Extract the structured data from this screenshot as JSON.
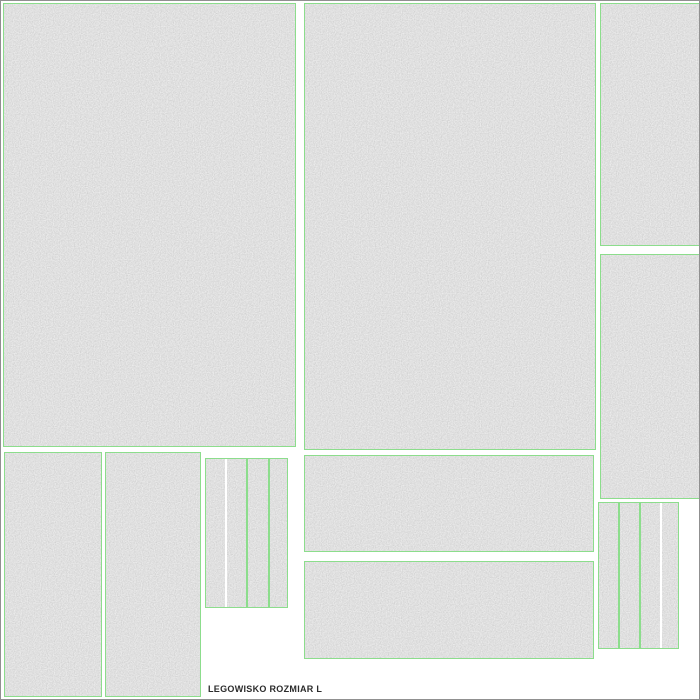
{
  "document": {
    "label": "LEGOWISKO ROZMIAR L"
  },
  "colors": {
    "outline_green": "#8cdd8c",
    "fabric_gray": "#c4c4c4",
    "canvas_white": "#ffffff",
    "frame_gray": "#909090",
    "label_text": "#2b2b2b"
  },
  "pieces": {
    "count": 10,
    "names": [
      "panel-top-left",
      "panel-top-center",
      "panel-top-right",
      "panel-right-middle",
      "panel-bottom-left-a",
      "panel-bottom-left-b",
      "strip-group-left",
      "band-upper",
      "band-lower",
      "strip-group-right"
    ]
  }
}
